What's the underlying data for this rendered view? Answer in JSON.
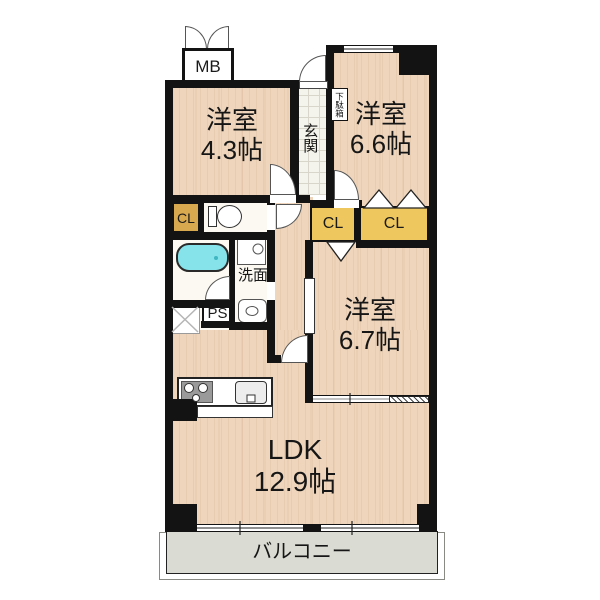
{
  "plan": {
    "mb": "MB",
    "genkan": "玄関",
    "getabako": "下駄箱",
    "room_nw": {
      "name": "洋室",
      "size": "4.3帖"
    },
    "room_ne": {
      "name": "洋室",
      "size": "6.6帖"
    },
    "room_e": {
      "name": "洋室",
      "size": "6.7帖"
    },
    "ldk": {
      "name": "LDK",
      "size": "12.9帖"
    },
    "closets": {
      "west": "CL",
      "center": "CL",
      "east": "CL"
    },
    "washroom": "洗面",
    "pipe_space": "PS",
    "balcony": "バルコニー",
    "colors": {
      "wall": "#131313",
      "wood_floor": "#eed5bc",
      "closet_yellow": "#eec75e",
      "closet_small_yellow": "#d8a94e",
      "bathtub_cyan": "#85e3e9",
      "balcony_gray": "#dadcd3",
      "entry_tile": "#f4f3ec"
    }
  }
}
